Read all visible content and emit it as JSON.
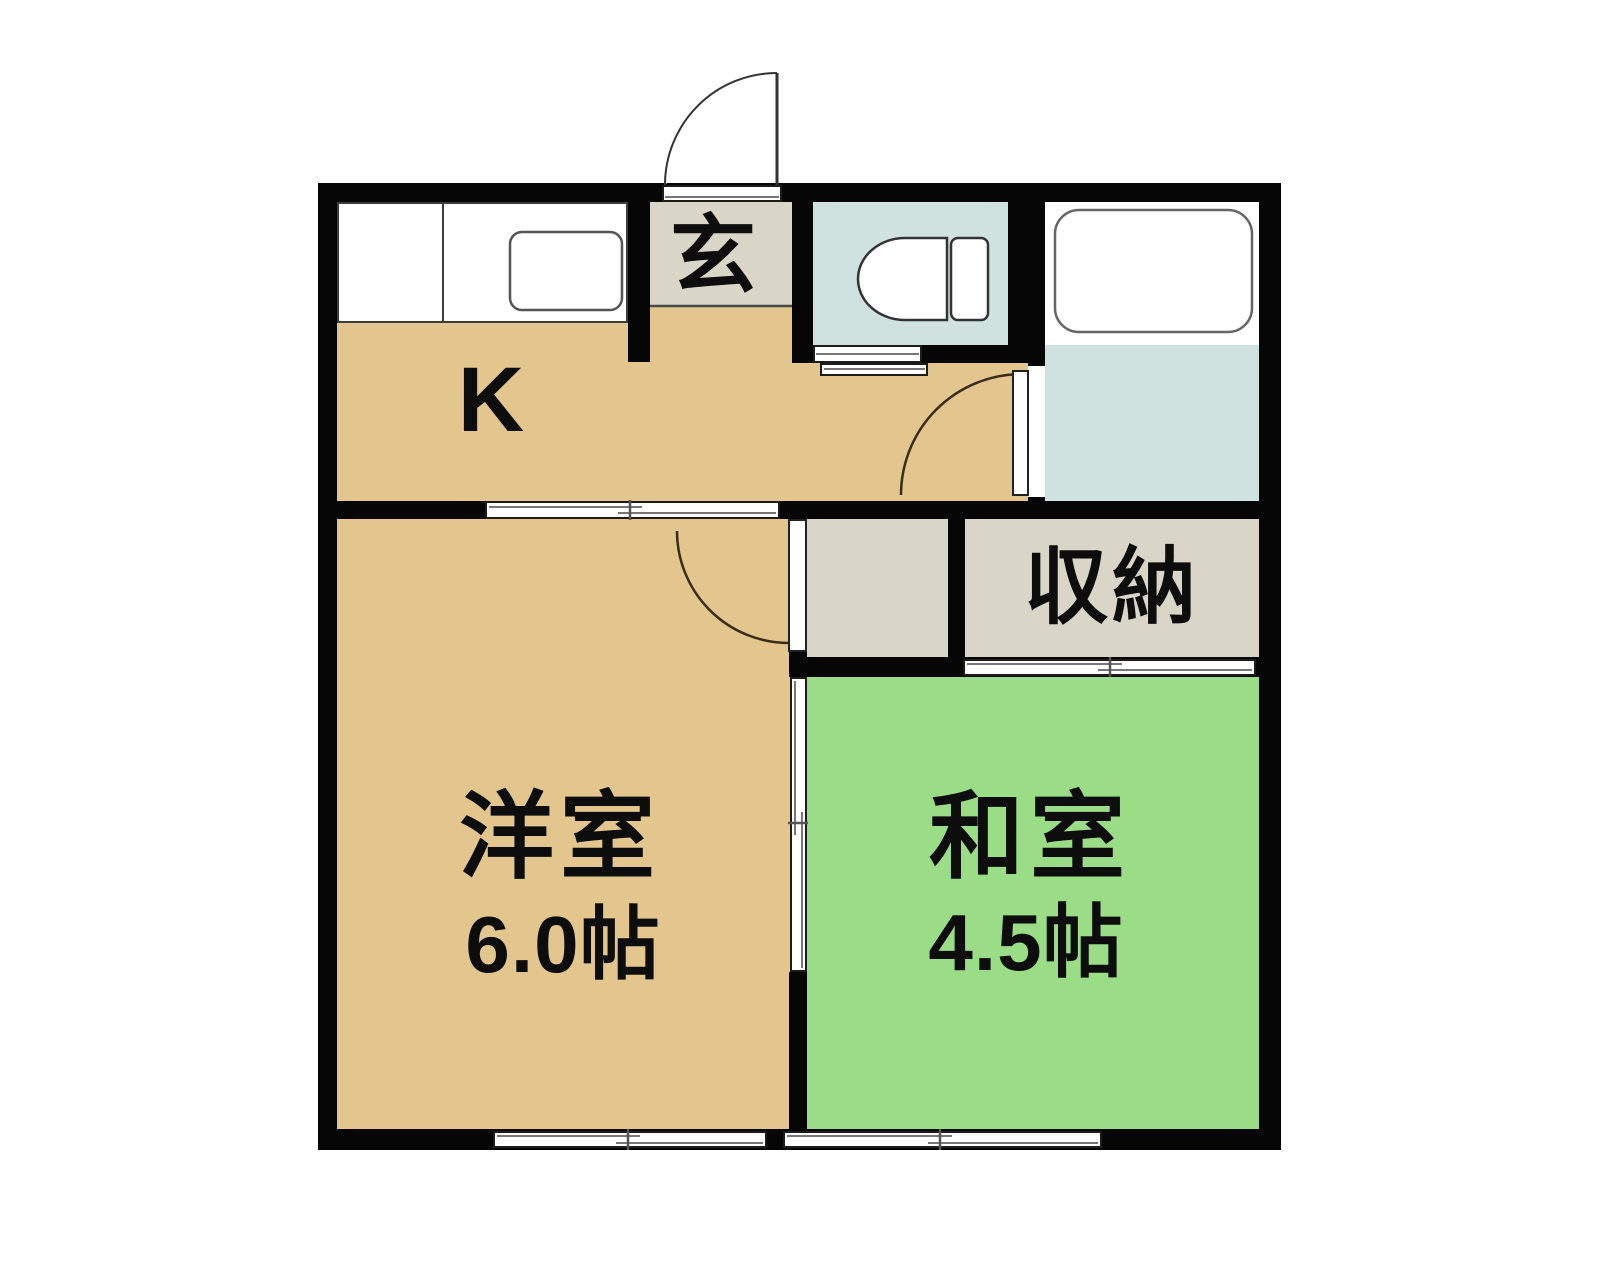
{
  "plan": {
    "kitchen": {
      "label": "K"
    },
    "entrance": {
      "label": "玄"
    },
    "storage": {
      "label": "収納"
    },
    "western_room": {
      "label": "洋室",
      "area": "6.0帖"
    },
    "japanese_room": {
      "label": "和室",
      "area": "4.5帖"
    }
  },
  "colors": {
    "wall": "#060606",
    "wood_floor_tan": "#e3c68e",
    "tatami_green": "#9bdc87",
    "wet_area_blue": "#cfe2e0",
    "storage_gray": "#d9d5c7",
    "fixture_outline": "#555555",
    "door_arc": "#3a2d18",
    "slider_line": "#777777"
  }
}
